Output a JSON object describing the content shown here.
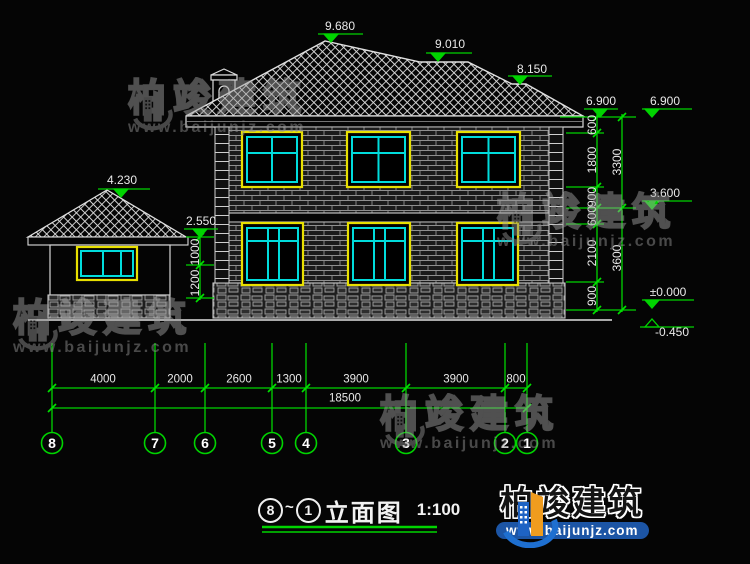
{
  "drawing": {
    "title": {
      "circle_start": "8",
      "separator": "~",
      "circle_end": "1",
      "text": "立面图",
      "scale": "1:100"
    },
    "labels": [
      [
        "9.680",
        340,
        26,
        "h"
      ],
      [
        "9.010",
        450,
        44,
        "h"
      ],
      [
        "8.150",
        532,
        69,
        "h"
      ],
      [
        "6.900",
        601,
        101,
        "h"
      ],
      [
        "6.900",
        665,
        101,
        "h"
      ],
      [
        "3.600",
        665,
        193,
        "h"
      ],
      [
        "±0.000",
        668,
        292,
        "h"
      ],
      [
        "-0.450",
        672,
        332,
        "h"
      ],
      [
        "4.230",
        122,
        180,
        "h"
      ],
      [
        "2.550",
        201,
        221,
        "h"
      ],
      [
        "600",
        592,
        125,
        "v"
      ],
      [
        "1800",
        592,
        160,
        "v"
      ],
      [
        "900",
        592,
        197,
        "v"
      ],
      [
        "600",
        592,
        216,
        "v"
      ],
      [
        "2100",
        592,
        253,
        "v"
      ],
      [
        "900",
        592,
        296,
        "v"
      ],
      [
        "3300",
        617,
        162,
        "v"
      ],
      [
        "3600",
        617,
        258,
        "v"
      ],
      [
        "1000",
        195,
        252,
        "v"
      ],
      [
        "1200",
        195,
        283,
        "v"
      ],
      [
        "4000",
        103,
        380,
        "dim"
      ],
      [
        "2000",
        180,
        380,
        "dim"
      ],
      [
        "2600",
        239,
        380,
        "dim"
      ],
      [
        "1300",
        289,
        380,
        "dim"
      ],
      [
        "3900",
        356,
        380,
        "dim"
      ],
      [
        "3900",
        456,
        380,
        "dim"
      ],
      [
        "800",
        516,
        380,
        "dim"
      ],
      [
        "18500",
        345,
        399,
        "dim"
      ]
    ],
    "grid": {
      "y": 443,
      "bubbles": [
        {
          "n": "8",
          "x": 52
        },
        {
          "n": "7",
          "x": 155
        },
        {
          "n": "6",
          "x": 205
        },
        {
          "n": "5",
          "x": 272
        },
        {
          "n": "4",
          "x": 306
        },
        {
          "n": "3",
          "x": 406
        },
        {
          "n": "2",
          "x": 505
        },
        {
          "n": "1",
          "x": 527
        }
      ]
    }
  },
  "watermark": {
    "text": "柏竣建筑",
    "url": "www.baijunjz.com",
    "positions": [
      {
        "x": 128,
        "y": 80
      },
      {
        "x": 497,
        "y": 194
      },
      {
        "x": 13,
        "y": 300
      },
      {
        "x": 380,
        "y": 396
      }
    ]
  },
  "logo": {
    "text": "柏竣建筑",
    "url": "www.baijunjz.com"
  },
  "colors": {
    "dim_green": "#00d400",
    "line_white": "#e0e0e0",
    "window_frame": "#e8e000",
    "window_mullion": "#00dcdc"
  }
}
